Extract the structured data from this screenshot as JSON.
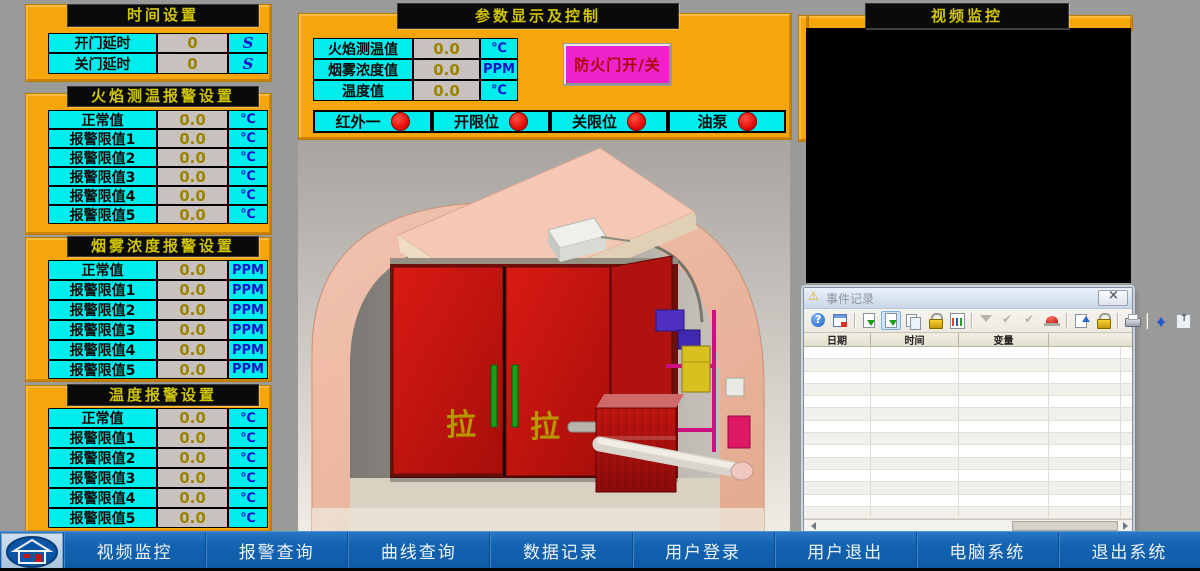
{
  "colors": {
    "orange": "#F6A50B",
    "cyan": "#00EDED",
    "magenta": "#EE22CC",
    "taskbar_blue": "#1565B2",
    "indicator_red": "#E00400",
    "bar_title_yellow": "#CFC400"
  },
  "time_panel": {
    "title": "时间设置",
    "rows": [
      {
        "label": "开门延时",
        "value": "0",
        "unit": "S"
      },
      {
        "label": "关门延时",
        "value": "0",
        "unit": "S"
      }
    ]
  },
  "flame_panel": {
    "title": "火焰测温报警设置",
    "rows": [
      {
        "label": "正常值",
        "value": "0.0",
        "unit": "℃"
      },
      {
        "label": "报警限值1",
        "value": "0.0",
        "unit": "℃"
      },
      {
        "label": "报警限值2",
        "value": "0.0",
        "unit": "℃"
      },
      {
        "label": "报警限值3",
        "value": "0.0",
        "unit": "℃"
      },
      {
        "label": "报警限值4",
        "value": "0.0",
        "unit": "℃"
      },
      {
        "label": "报警限值5",
        "value": "0.0",
        "unit": "℃"
      }
    ]
  },
  "smoke_panel": {
    "title": "烟雾浓度报警设置",
    "rows": [
      {
        "label": "正常值",
        "value": "0.0",
        "unit": "PPM"
      },
      {
        "label": "报警限值1",
        "value": "0.0",
        "unit": "PPM"
      },
      {
        "label": "报警限值2",
        "value": "0.0",
        "unit": "PPM"
      },
      {
        "label": "报警限值3",
        "value": "0.0",
        "unit": "PPM"
      },
      {
        "label": "报警限值4",
        "value": "0.0",
        "unit": "PPM"
      },
      {
        "label": "报警限值5",
        "value": "0.0",
        "unit": "PPM"
      }
    ]
  },
  "temp_panel": {
    "title": "温度报警设置",
    "rows": [
      {
        "label": "正常值",
        "value": "0.0",
        "unit": "℃"
      },
      {
        "label": "报警限值1",
        "value": "0.0",
        "unit": "℃"
      },
      {
        "label": "报警限值2",
        "value": "0.0",
        "unit": "℃"
      },
      {
        "label": "报警限值3",
        "value": "0.0",
        "unit": "℃"
      },
      {
        "label": "报警限值4",
        "value": "0.0",
        "unit": "℃"
      },
      {
        "label": "报警限值5",
        "value": "0.0",
        "unit": "℃"
      }
    ]
  },
  "param_panel": {
    "title": "参数显示及控制",
    "rows": [
      {
        "label": "火焰测温值",
        "value": "0.0",
        "unit": "℃"
      },
      {
        "label": "烟雾浓度值",
        "value": "0.0",
        "unit": "PPM"
      },
      {
        "label": "温度值",
        "value": "0.0",
        "unit": "℃"
      }
    ],
    "door_button": "防火门开/关",
    "indicators": [
      {
        "label": "红外一"
      },
      {
        "label": "开限位"
      },
      {
        "label": "关限位"
      },
      {
        "label": "油泵"
      }
    ]
  },
  "video_panel": {
    "title": "视频监控"
  },
  "scene": {
    "door_label": "拉"
  },
  "event_window": {
    "title": "事件记录",
    "columns": [
      "日期",
      "时间",
      "变量"
    ],
    "toolbar_icons": [
      "help-icon",
      "calendar-icon",
      "export-icon",
      "export-selected-icon",
      "copy-icon",
      "lock-icon",
      "chart-icon",
      "filter-disabled-icon",
      "confirm-disabled-icon",
      "confirm-all-disabled-icon",
      "alarm-icon",
      "note-icon",
      "lock-arrow-icon",
      "print-icon",
      "sort-icon",
      "to-top-icon"
    ],
    "status": [
      "待处理：0",
      "待确认：0",
      "已隐藏：0",
      "列表：0"
    ],
    "clock": "12:29:02"
  },
  "taskbar": {
    "buttons": [
      {
        "label": "视频监控"
      },
      {
        "label": "报警查询"
      },
      {
        "label": "曲线查询"
      },
      {
        "label": "数据记录"
      },
      {
        "label": "用户登录"
      },
      {
        "label": "用户退出"
      },
      {
        "label": "电脑系统"
      },
      {
        "label": "退出系统"
      }
    ]
  }
}
